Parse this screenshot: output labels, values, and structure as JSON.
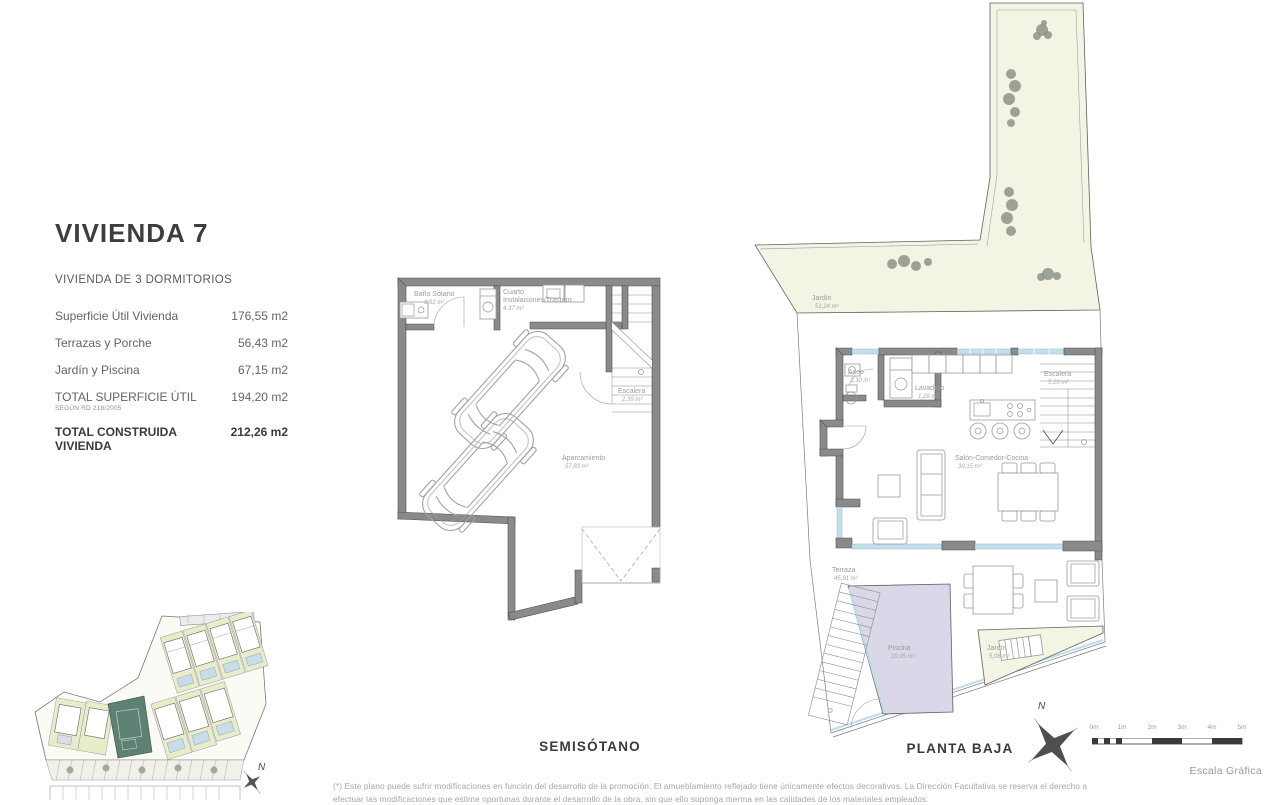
{
  "info_panel": {
    "title": "VIVIENDA 7",
    "subtitle": "VIVIENDA DE 3 DORMITORIOS",
    "rows": [
      {
        "label": "Superficie Útil Vivienda",
        "value": "176,55 m2"
      },
      {
        "label": "Terrazas y Porche",
        "value": "56,43 m2"
      },
      {
        "label": "Jardín y Piscina",
        "value": "67,15 m2"
      },
      {
        "label": "TOTAL SUPERFICIE ÚTIL",
        "note": "SEGÚN RD 218/2005",
        "value": "194,20 m2"
      },
      {
        "label": "TOTAL CONSTRUIDA VIVIENDA",
        "value": "212,26 m2"
      }
    ]
  },
  "semisotano": {
    "caption": "SEMISÓTANO",
    "rooms": {
      "bano": {
        "name": "Baño Sótano",
        "area": "3,92 m²"
      },
      "cuarto": {
        "name": "Cuarto",
        "name2": "Instalaciones/Trastero",
        "area": "4,37 m²"
      },
      "escalera": {
        "name": "Escalera",
        "area": "2,39 m²"
      },
      "aparcamiento": {
        "name": "Aparcamiento",
        "area": "57,83 m²"
      }
    }
  },
  "planta_baja": {
    "caption": "PLANTA BAJA",
    "rooms": {
      "jardin_grande": {
        "name": "Jardín",
        "area": "51,24 m²"
      },
      "aseo": {
        "name": "Aseo",
        "area": "3,30 m²"
      },
      "lavadero": {
        "name": "Lavadero",
        "area": "1,28 m²"
      },
      "escalera": {
        "name": "Escalera",
        "area": "5,10 m²"
      },
      "salon": {
        "name": "Salón-Comedor-Cocina",
        "area": "39,15 m²"
      },
      "terraza": {
        "name": "Terraza",
        "area": "45,91 m²"
      },
      "piscina": {
        "name": "Piscina",
        "area": "10,95 m²"
      },
      "jardin_peq": {
        "name": "Jardín",
        "area": "5,06 m²"
      }
    }
  },
  "compass": {
    "label": "N"
  },
  "scale_bar": {
    "ticks": [
      "0m",
      "1m",
      "2m",
      "3m",
      "4m",
      "5m"
    ],
    "caption": "Escala Gráfica"
  },
  "footnote": {
    "line1": "(*) Este plano puede sufrir modificaciones en función del desarrollo de la promoción. El amueblamiento reflejado tiene únicamente efectos decorativos. La Dirección Facultativa se reserva el derecho a",
    "line2": "efectuar las modificaciones que estime oportunas durante el desarrollo de la obra, sin que ello suponga merma en las calidades de los materiales empleados."
  },
  "colors": {
    "wall": "#8a8a8a",
    "garden": "#f3f4e4",
    "pool": "#d9d7e8",
    "window": "#c3dfe9",
    "site_highlight": "#5d8172"
  }
}
